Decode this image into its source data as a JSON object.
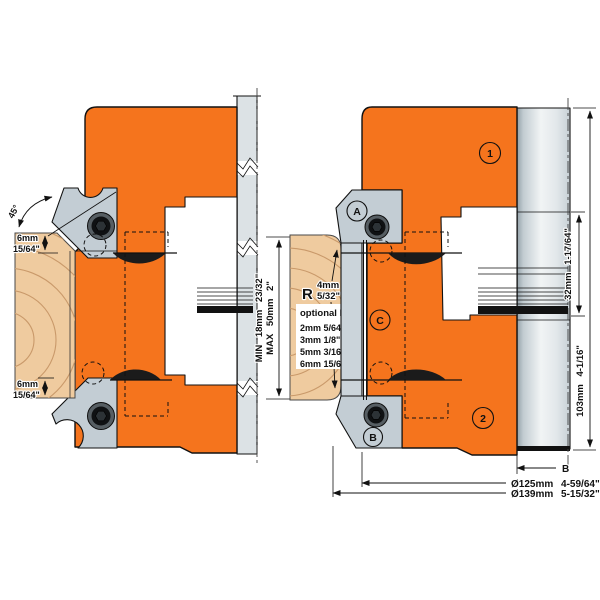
{
  "left_view": {
    "angle": "45°",
    "top_depth": {
      "mm": "6mm",
      "in": "15/64\""
    },
    "bottom_depth": {
      "mm": "6mm",
      "in": "15/64\""
    }
  },
  "workpiece": {
    "min": "MIN 18mm 23/32\"",
    "max": "MAX 50mm 2\"",
    "radius": {
      "prefix": "R",
      "mm": "4mm",
      "in": "5/32\""
    },
    "optional": {
      "title": "optional R",
      "options": [
        "2mm 5/64\"",
        "3mm 1/8\"",
        "5mm 3/16\"",
        "6mm 15/64\""
      ]
    }
  },
  "markers": {
    "head_top": "1",
    "head_bottom": "2",
    "knife_top": "A",
    "knife_bottom": "B",
    "body": "C"
  },
  "dimensions": {
    "bore_length": "32mm 1-17/64\"",
    "total_height": "103mm 4-1/16\"",
    "b": "B",
    "cutting_dia": "Ø125mm 4-59/64\"",
    "max_dia": "Ø139mm 5-15/32\""
  },
  "colors": {
    "body_orange": "#F5741D",
    "steel_gray": "#C3CDD4",
    "wood_tan": "#EFCB9F",
    "line_black": "#111111"
  }
}
